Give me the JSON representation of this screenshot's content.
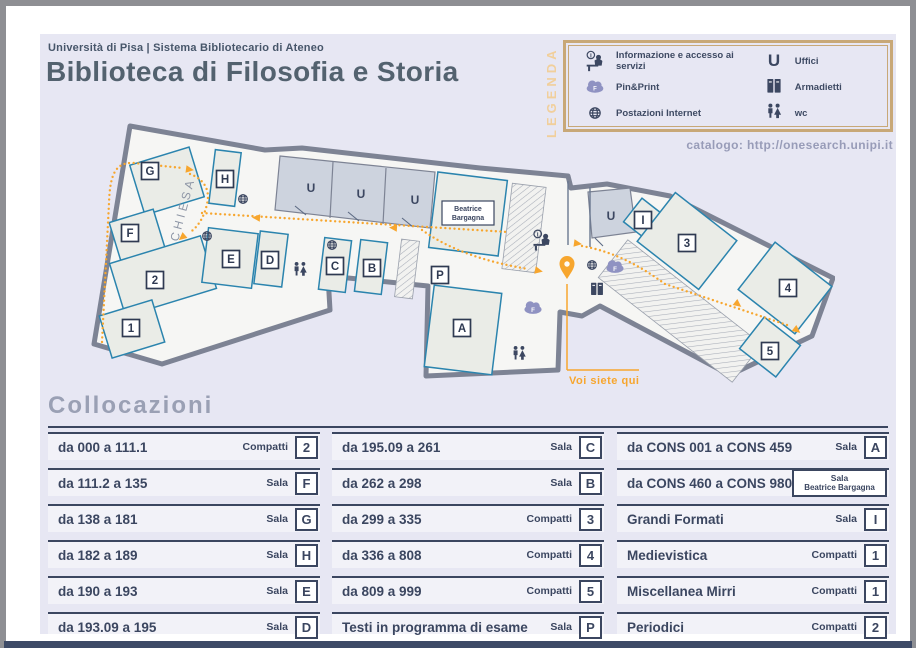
{
  "header": {
    "subtitle": "Università di Pisa | Sistema Bibliotecario di Ateneo",
    "title": "Biblioteca di Filosofia e Storia"
  },
  "legend": {
    "title": "LEGENDA",
    "items": [
      {
        "icon": "info-desk-icon",
        "label": "Informazione e accesso ai servizi"
      },
      {
        "icon": "print-cloud-icon",
        "label": "Pin&Print"
      },
      {
        "icon": "globe-icon",
        "label": "Postazioni Internet"
      },
      {
        "icon": "letter-u-icon",
        "label": "Uffici"
      },
      {
        "icon": "lockers-icon",
        "label": "Armadietti"
      },
      {
        "icon": "wc-icon",
        "label": "wc"
      }
    ],
    "print_letter": "F",
    "info_letter": "i",
    "catalog_line": "catalogo: http://onesearch.unipi.it"
  },
  "map": {
    "church_label": "CHIESA",
    "office_letter": "U",
    "bargagna_line1": "Beatrice",
    "bargagna_line2": "Bargagna",
    "you_are_here": "Voi siete qui",
    "rooms": [
      "G",
      "F",
      "2",
      "1",
      "H",
      "E",
      "D",
      "C",
      "B",
      "A",
      "P",
      "I",
      "3",
      "4",
      "5"
    ]
  },
  "collocazioni": {
    "heading": "Collocazioni",
    "bargagna_badge": {
      "line1": "Sala",
      "line2": "Beatrice Bargagna"
    },
    "rows": [
      {
        "range": "da 000 a 111.1",
        "type": "Compatti",
        "room": "2"
      },
      {
        "range": "da 111.2 a 135",
        "type": "Sala",
        "room": "F"
      },
      {
        "range": "da 138 a 181",
        "type": "Sala",
        "room": "G"
      },
      {
        "range": "da 182 a 189",
        "type": "Sala",
        "room": "H"
      },
      {
        "range": "da 190 a 193",
        "type": "Sala",
        "room": "E"
      },
      {
        "range": "da 193.09 a 195",
        "type": "Sala",
        "room": "D"
      },
      {
        "range": "da 195.09 a 261",
        "type": "Sala",
        "room": "C"
      },
      {
        "range": "da 262 a 298",
        "type": "Sala",
        "room": "B"
      },
      {
        "range": "da 299 a 335",
        "type": "Compatti",
        "room": "3"
      },
      {
        "range": "da 336 a 808",
        "type": "Compatti",
        "room": "4"
      },
      {
        "range": "da 809 a 999",
        "type": "Compatti",
        "room": "5"
      },
      {
        "range": "Testi in programma di esame",
        "type": "Sala",
        "room": "P"
      },
      {
        "range": "da CONS 001 a CONS 459",
        "type": "Sala",
        "room": "A"
      },
      {
        "range": "da CONS 460 a CONS 980",
        "type": "",
        "room": ""
      },
      {
        "range": "Grandi Formati",
        "type": "Sala",
        "room": "I"
      },
      {
        "range": "Medievistica",
        "type": "Compatti",
        "room": "1"
      },
      {
        "range": "Miscellanea Mirri",
        "type": "Compatti",
        "room": "1"
      },
      {
        "range": "Periodici",
        "type": "Compatti",
        "room": "2"
      }
    ]
  },
  "colors": {
    "accent_orange": "#f7a62e",
    "legend_tan": "#c8a877",
    "navy": "#3b4660",
    "panel_lavender": "#e7e7f3",
    "room_stroke": "#2b84ae",
    "wall_gray": "#7d8394"
  }
}
